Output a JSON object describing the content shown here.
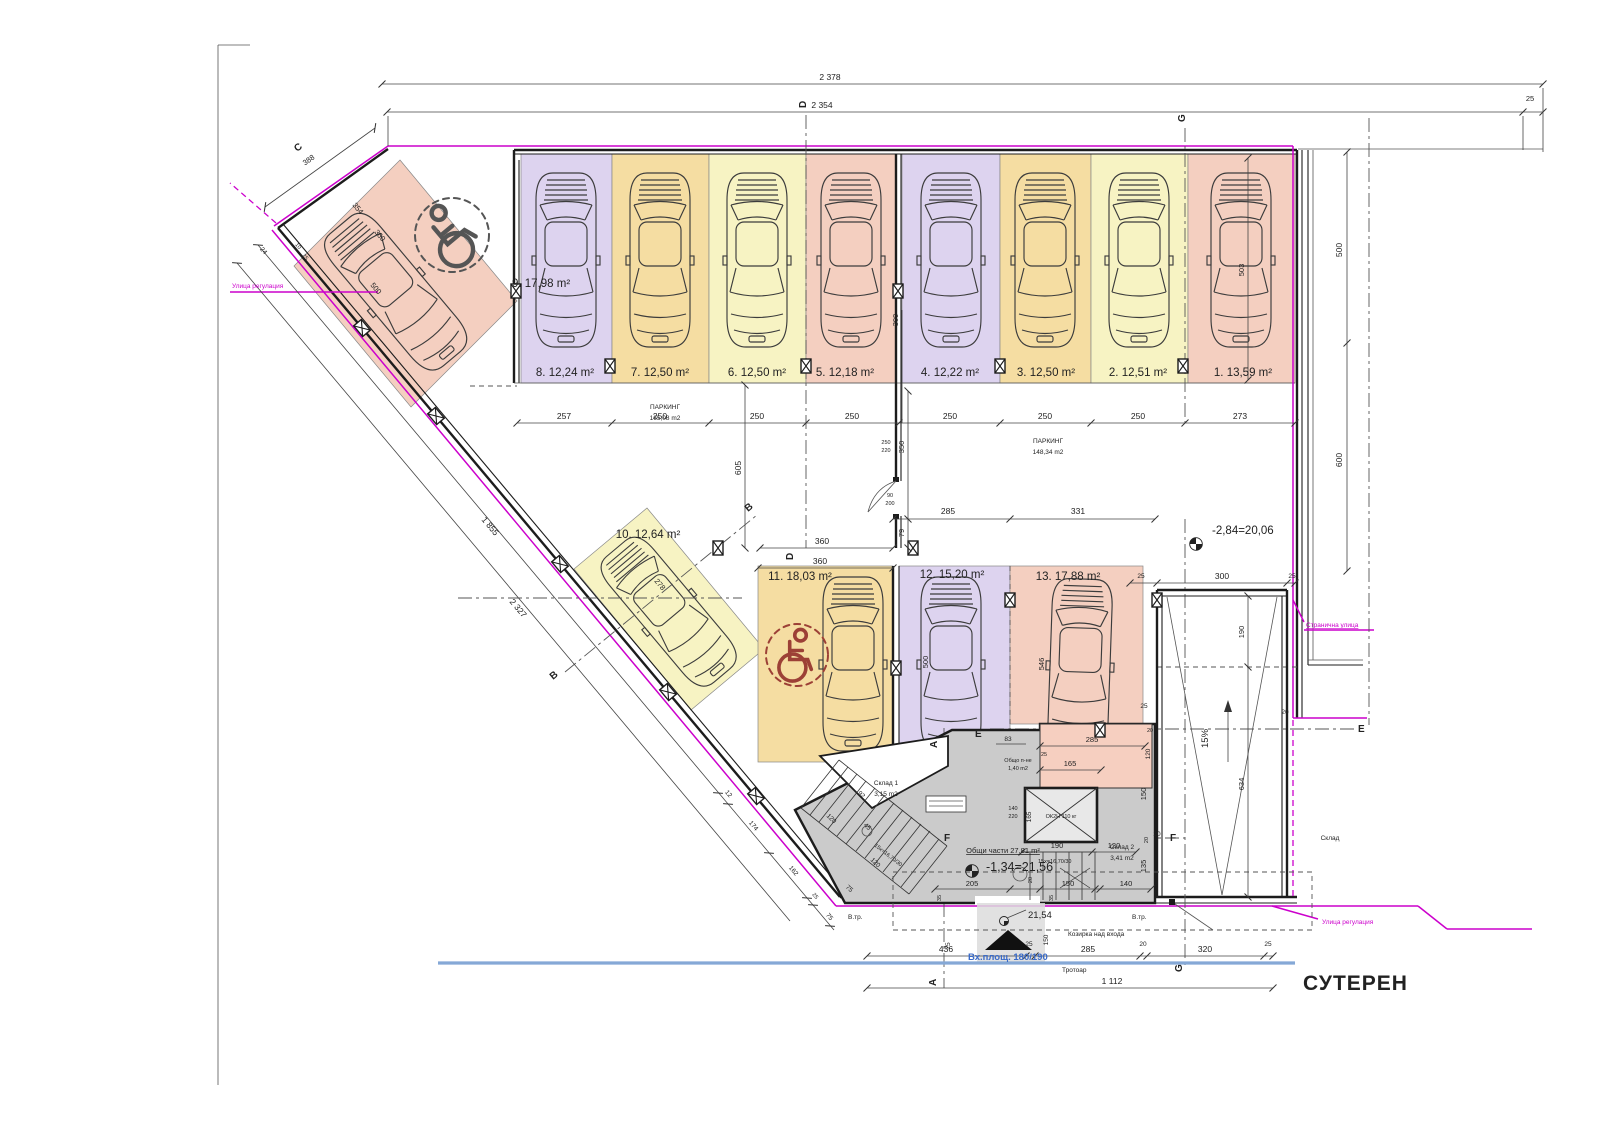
{
  "title": "СУТЕРЕН",
  "spaces": {
    "s1": "1. 13,59 m²",
    "s2": "2. 12,51 m²",
    "s3": "3. 12,50 m²",
    "s4": "4. 12,22 m²",
    "s5": "5. 12,18 m²",
    "s6": "6. 12,50 m²",
    "s7": "7. 12,50 m²",
    "s8": "8. 12,24 m²",
    "s9": "9. 17,98 m²",
    "s10": "10. 12,64 m²",
    "s11": "11. 18,03 m²",
    "s12": "12. 15,20 m²",
    "s13": "13. 17,88 m²"
  },
  "zones": {
    "p1_name": "ПАРКИНГ",
    "p1_area": "165,08 m2",
    "p2_name": "ПАРКИНГ",
    "p2_area": "148,34 m2"
  },
  "rooms": {
    "storage1_name": "Склад 1",
    "storage1_area": "3,15 m2",
    "storage2_name": "Склад 2",
    "storage2_area": "3,41 m2",
    "common_label": "Общи части 27,81 m²",
    "lobby_name": "Общо п-не",
    "lobby_area": "1,40 m2",
    "neighbor_storage": "Склад",
    "elevator": "ОК2Н 110 кг"
  },
  "levels": {
    "garage": "-2,84=20,06",
    "core": "-1,34=21,56",
    "entrance": "21,54"
  },
  "site": {
    "regulation_left": "Улица регулация",
    "regulation_right": "Улица регулация",
    "side_street": "Странична улица",
    "sidewalk": "Тротоар",
    "entrance_area": "Вх.площ. 180/190",
    "canopy": "Козирка над входа",
    "vtr1": "В.тр.",
    "vtr2": "В.тр."
  },
  "grid": {
    "a": "A",
    "b": "B",
    "c": "C",
    "d": "D",
    "e": "E",
    "f": "F",
    "g": "G"
  },
  "ramp_info": {
    "slope": "15%"
  },
  "stair": {
    "formula": "15x=16,70/30"
  },
  "dims": {
    "top_outer": "2 378",
    "top_inner": "2 354",
    "top_off": "25",
    "row": [
      "257",
      "250",
      "250",
      "250",
      "250",
      "250",
      "250",
      "273"
    ],
    "d309": "309",
    "d503": "503",
    "d500r": "500",
    "d600r": "600",
    "d605": "605",
    "d360a": "360",
    "d360b": "360",
    "d285": "285",
    "d331": "331",
    "d350": "350",
    "d79": "79",
    "door1": [
      "250",
      "220"
    ],
    "door2": [
      "90",
      "200"
    ],
    "door3": [
      "140",
      "220"
    ],
    "s9": [
      "354",
      "360",
      "500",
      "388",
      "24",
      "10",
      "25"
    ],
    "s10": "278",
    "s12_500": "500",
    "s13_546": "546",
    "diag": [
      "1 855",
      "2 327",
      "12",
      "174",
      "162",
      "25",
      "75"
    ],
    "ramp": [
      "300",
      "25",
      "25",
      "190",
      "634",
      "25",
      "120",
      "20",
      "20"
    ],
    "core": [
      "83",
      "285",
      "165",
      "25",
      "20",
      "92",
      "120",
      "45",
      "120",
      "75",
      "190",
      "120",
      "165",
      "150",
      "135",
      "20",
      "205",
      "150",
      "140",
      "35",
      "35",
      "20"
    ],
    "entry": [
      "75",
      "150"
    ],
    "bottom": [
      "436",
      "25",
      "285",
      "20",
      "320",
      "25",
      "1 112"
    ]
  }
}
